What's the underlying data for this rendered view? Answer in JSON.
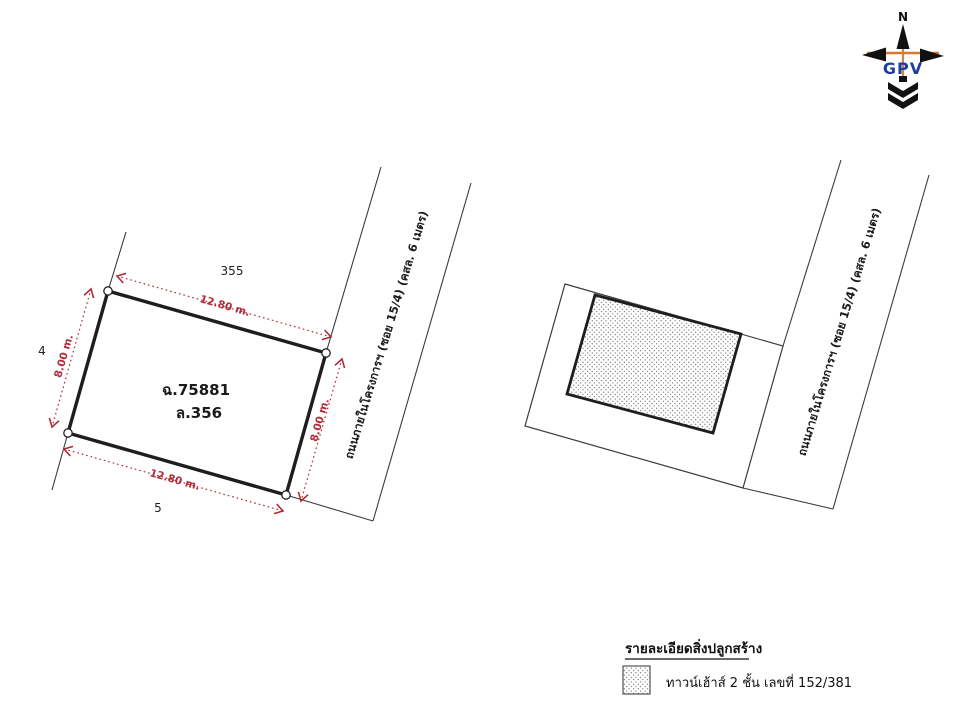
{
  "compass": {
    "north_label": "N",
    "logo": "GPV"
  },
  "left_parcel": {
    "deed_number": "ฉ.75881",
    "lot_number": "ล.356",
    "adjacent_lot_top": "355",
    "adjacent_lot_left": "4",
    "adjacent_lot_bottom": "5",
    "dim_top": "12.80 m.",
    "dim_bottom": "12.80 m.",
    "dim_left": "8.00 m.",
    "dim_right": "8.00 m.",
    "road_label": "ถนนภายในโครงการฯ (ซอย 15/4) (คสล. 6 เมตร)"
  },
  "right_parcel": {
    "road_label": "ถนนภายในโครงการฯ (ซอย 15/4) (คสล. 6 เมตร)"
  },
  "legend": {
    "title": "รายละเอียดสิ่งปลูกสร้าง",
    "item_label": "ทาวน์เฮ้าส์ 2 ชั้น เลขที่ 152/381"
  },
  "colors": {
    "dimension_red": "#b02a37",
    "boundary_dark": "#1e1e1e",
    "road_line_gray": "#3c3c3c",
    "gpv_blue": "#1c3e9e",
    "compass_orange": "#d9772e"
  }
}
